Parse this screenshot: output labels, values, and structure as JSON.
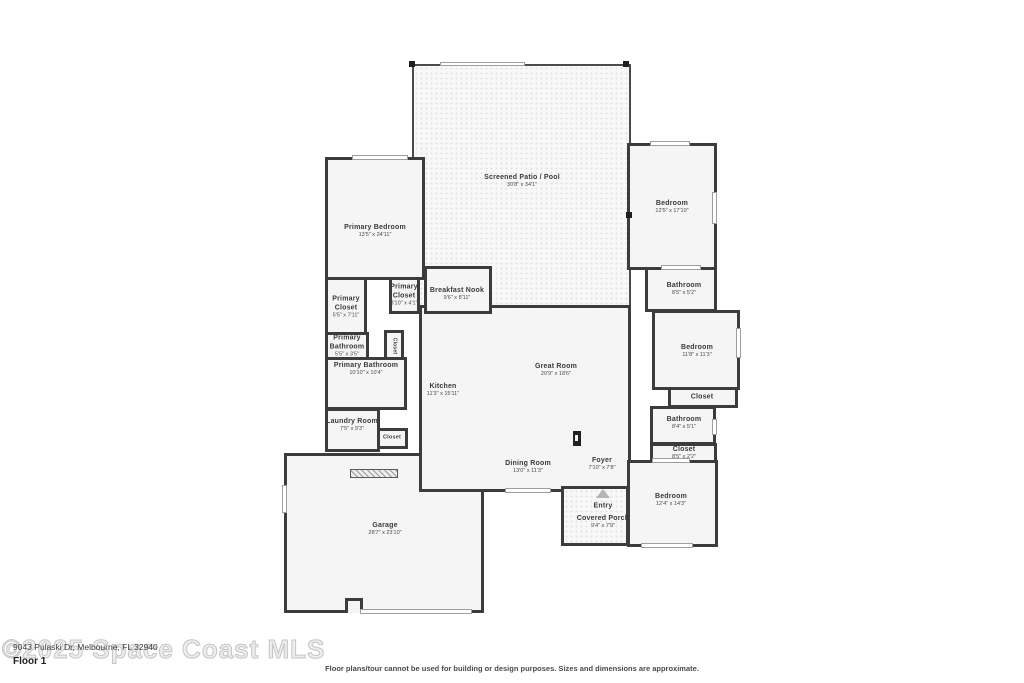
{
  "floorplan": {
    "floor_label": "Floor 1",
    "watermark": "©2025 Space Coast MLS",
    "address": "9043 Pulaski Dr, Melbourne, FL 32940",
    "disclaimer": "Floor plans/tour cannot be used for building or design purposes. Sizes and dimensions are approximate.",
    "colors": {
      "wall": "#3c3c3c",
      "room_fill": "#f5f5f5",
      "label_text": "#3a3a3a",
      "watermark": "#d9d9d9",
      "background": "#ffffff"
    },
    "rooms": {
      "screened_patio": {
        "name": "Screened Patio / Pool",
        "dims": "30'8\" x 34'1\""
      },
      "primary_bedroom": {
        "name": "Primary Bedroom",
        "dims": "13'5\" x 24'11\""
      },
      "primary_closet_large": {
        "name": "Primary Closet",
        "dims": "5'5\" x 7'11\""
      },
      "primary_closet_small": {
        "name": "Primary Closet",
        "dims": "3'10\" x 4'1\""
      },
      "breakfast_nook": {
        "name": "Breakfast Nook",
        "dims": "9'6\" x 8'11\""
      },
      "primary_bathroom_small": {
        "name": "Primary Bathroom",
        "dims": "5'5\" x 3'5\""
      },
      "hall_closet": {
        "name": "Closet"
      },
      "primary_bathroom": {
        "name": "Primary Bathroom",
        "dims": "10'10\" x 10'4\""
      },
      "kitchen": {
        "name": "Kitchen",
        "dims": "11'3\" x 15'11\""
      },
      "great_room": {
        "name": "Great Room",
        "dims": "20'9\" x 18'6\""
      },
      "laundry_room": {
        "name": "Laundry Room",
        "dims": "7'5\" x 9'3\""
      },
      "laundry_closet": {
        "name": "Closet"
      },
      "dining_room": {
        "name": "Dining Room",
        "dims": "13'0\" x 11'3\""
      },
      "foyer": {
        "name": "Foyer",
        "dims": "7'10\" x 7'8\""
      },
      "entry": {
        "name": "Entry"
      },
      "covered_porch": {
        "name": "Covered Porch",
        "dims": "9'4\" x 7'9\""
      },
      "garage": {
        "name": "Garage",
        "dims": "28'7\" x 23'10\""
      },
      "bedroom_top_right": {
        "name": "Bedroom",
        "dims": "12'5\" x 17'10\""
      },
      "bathroom_top_right": {
        "name": "Bathroom",
        "dims": "8'5\" x 5'2\""
      },
      "bedroom_mid_right": {
        "name": "Bedroom",
        "dims": "11'8\" x 11'3\""
      },
      "closet_mid_right": {
        "name": "Closet"
      },
      "bathroom_mid_right": {
        "name": "Bathroom",
        "dims": "8'4\" x 5'1\""
      },
      "closet_lower_right": {
        "name": "Closet",
        "dims": "8'5\" x 2'2\""
      },
      "bedroom_bottom_right": {
        "name": "Bedroom",
        "dims": "12'4\" x 14'3\""
      }
    }
  }
}
